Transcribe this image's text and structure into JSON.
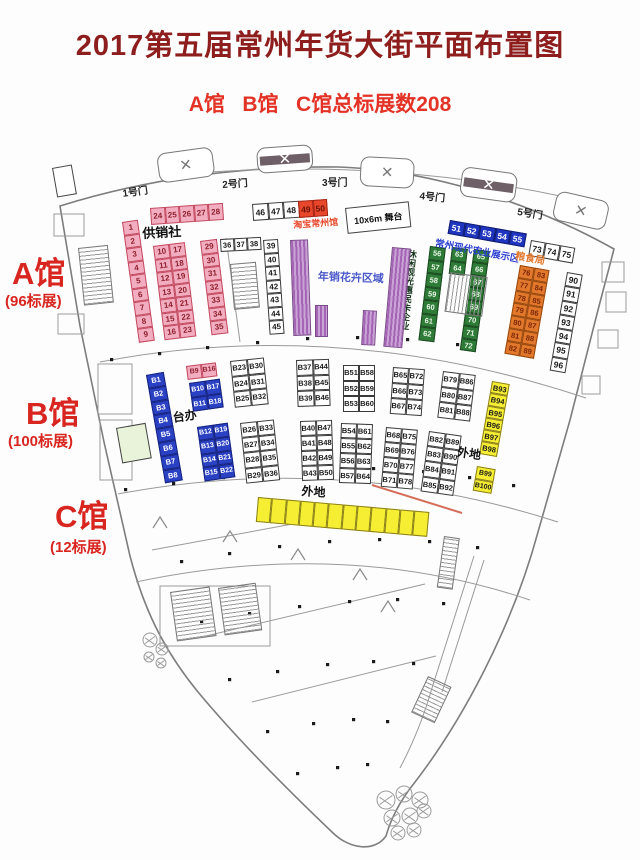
{
  "title": "2017第五届常州年货大街平面布置图",
  "subtitle": "A馆   B馆   C馆总标展数208",
  "colors": {
    "title": "#8e1d1d",
    "subtitle": "#e33226",
    "hall_label": "#d8251f",
    "purple_strip_dark": "#a565b5",
    "purple_strip_light": "#c9a2d6"
  },
  "plan": {
    "booth_styles": {
      "pink": {
        "bg": "#f2aec0",
        "border": "#c34a60",
        "text": "#8e1f2e"
      },
      "red": {
        "bg": "#e8472b",
        "border": "#a32413",
        "text": "#6d1208"
      },
      "white": {
        "bg": "#ffffff",
        "border": "#3a3a3a",
        "text": "#1a1a1a"
      },
      "blue": {
        "bg": "#2b41c4",
        "border": "#16247f",
        "text": "#ffffff"
      },
      "bluestrip": {
        "bg": "#1f35c0",
        "border": "#101d6e",
        "text": "#ffffff"
      },
      "green": {
        "bg": "#2f7c39",
        "border": "#1b4a20",
        "text": "#eaf6e6"
      },
      "orange": {
        "bg": "#e2782b",
        "border": "#96480e",
        "text": "#7a2606"
      },
      "yellow": {
        "bg": "#f6ee33",
        "border": "#8a7f1a",
        "text": "#1a1a1a"
      }
    },
    "groups": [
      {
        "name": "a-col-1-9",
        "x": 122,
        "y": 222,
        "rot": -8,
        "cols": 1,
        "cw": 16,
        "ch": 13.5,
        "fs": 8,
        "style": "pink",
        "values": [
          "1",
          "2",
          "3",
          "4",
          "5",
          "6",
          "7",
          "8",
          "9"
        ]
      },
      {
        "name": "a-row-24-28",
        "x": 150,
        "y": 208,
        "rot": -4,
        "cols": 5,
        "cw": 14.5,
        "ch": 17,
        "fs": 8,
        "style": "pink",
        "values": [
          "24",
          "25",
          "26",
          "27",
          "28"
        ]
      },
      {
        "name": "a-grid-10-23",
        "x": 153,
        "y": 246,
        "rot": -7,
        "cols": 2,
        "cw": 16,
        "ch": 13.5,
        "fs": 8,
        "style": "pink",
        "values": [
          "10",
          "17",
          "11",
          "18",
          "12",
          "19",
          "13",
          "20",
          "14",
          "21",
          "15",
          "22",
          "16",
          "23"
        ]
      },
      {
        "name": "a-col-29-35",
        "x": 200,
        "y": 241,
        "rot": -7,
        "cols": 1,
        "cw": 17,
        "ch": 13.5,
        "fs": 8,
        "style": "pink",
        "values": [
          "29",
          "30",
          "31",
          "32",
          "33",
          "34",
          "35"
        ]
      },
      {
        "name": "a-row-36-38",
        "x": 220,
        "y": 239,
        "rot": -3,
        "cols": 3,
        "cw": 13.5,
        "ch": 13,
        "fs": 7.5,
        "style": "white",
        "values": [
          "36",
          "37",
          "38"
        ]
      },
      {
        "name": "a-col-39-45",
        "x": 263,
        "y": 240,
        "rot": -4,
        "cols": 1,
        "cw": 15,
        "ch": 13.5,
        "fs": 8,
        "style": "white",
        "values": [
          "39",
          "40",
          "41",
          "42",
          "43",
          "44",
          "45"
        ]
      },
      {
        "name": "a-row-46-48",
        "x": 252,
        "y": 204,
        "rot": -4,
        "cols": 3,
        "cw": 15.5,
        "ch": 17,
        "fs": 8.5,
        "style": "white",
        "values": [
          "46",
          "47",
          "48"
        ]
      },
      {
        "name": "a-row-49-50",
        "x": 298,
        "y": 201,
        "rot": -4,
        "cols": 2,
        "cw": 14.5,
        "ch": 17,
        "fs": 8.5,
        "style": "red",
        "values": [
          "49",
          "50"
        ]
      },
      {
        "name": "a-strip-51-55",
        "x": 450,
        "y": 220,
        "rot": 10,
        "cols": 5,
        "cw": 15.5,
        "ch": 14,
        "fs": 8.5,
        "style": "bluestrip",
        "values": [
          "51",
          "52",
          "53",
          "54",
          "55"
        ]
      },
      {
        "name": "a-col-56-62",
        "x": 430,
        "y": 246,
        "rot": 7,
        "cols": 1,
        "cw": 16,
        "ch": 13.5,
        "fs": 7.5,
        "style": "green",
        "values": [
          "56",
          "57",
          "58",
          "59",
          "60",
          "61",
          "62"
        ]
      },
      {
        "name": "a-col-63-64",
        "x": 452,
        "y": 247,
        "rot": 7,
        "cols": 1,
        "cw": 16,
        "ch": 13.5,
        "fs": 7.5,
        "style": "green",
        "values": [
          "63",
          "64"
        ]
      },
      {
        "name": "a-col-65-72",
        "x": 474,
        "y": 249,
        "rot": 8,
        "cols": 1,
        "cw": 16,
        "ch": 12.8,
        "fs": 7.5,
        "style": "green",
        "values": [
          "65",
          "66",
          "67",
          "68",
          "69",
          "70",
          "71",
          "72"
        ]
      },
      {
        "name": "a-row-73-75",
        "x": 531,
        "y": 240,
        "rot": 10,
        "cols": 3,
        "cw": 15,
        "ch": 16,
        "fs": 8.5,
        "style": "white",
        "values": [
          "73",
          "74",
          "75"
        ]
      },
      {
        "name": "a-grid-76-89",
        "x": 520,
        "y": 265,
        "rot": 10,
        "cols": 2,
        "cw": 15,
        "ch": 12.8,
        "fs": 7.5,
        "style": "orange",
        "values": [
          "76",
          "83",
          "77",
          "84",
          "78",
          "85",
          "79",
          "86",
          "80",
          "87",
          "81",
          "88",
          "82",
          "89"
        ]
      },
      {
        "name": "a-col-90-96",
        "x": 567,
        "y": 272,
        "rot": 10,
        "cols": 1,
        "cw": 15.5,
        "ch": 14.3,
        "fs": 8.5,
        "style": "white",
        "values": [
          "90",
          "91",
          "92",
          "93",
          "94",
          "95",
          "96"
        ]
      },
      {
        "name": "b-col-b1-b8",
        "x": 146,
        "y": 375,
        "rot": -10,
        "cols": 1,
        "cw": 18,
        "ch": 13.8,
        "fs": 7.5,
        "style": "blue",
        "values": [
          "B1",
          "B2",
          "B3",
          "B4",
          "B5",
          "B6",
          "B7",
          "B8"
        ]
      },
      {
        "name": "b-row-b9-b16",
        "x": 186,
        "y": 366,
        "rot": -7,
        "cols": 2,
        "cw": 15,
        "ch": 13.5,
        "fs": 7,
        "style": "pink",
        "values": [
          "B9",
          "B16"
        ]
      },
      {
        "name": "b-grid-b10-b18",
        "x": 189,
        "y": 383,
        "rot": -8,
        "cols": 2,
        "cw": 15.5,
        "ch": 14.5,
        "fs": 7,
        "style": "blue",
        "values": [
          "B10",
          "B17",
          "B11",
          "B18"
        ]
      },
      {
        "name": "b-grid-b12-b22",
        "x": 197,
        "y": 427,
        "rot": -8,
        "cols": 2,
        "cw": 15.5,
        "ch": 13.8,
        "fs": 7,
        "style": "blue",
        "values": [
          "B12",
          "B19",
          "B13",
          "B20",
          "B14",
          "B21",
          "B15",
          "B22"
        ]
      },
      {
        "name": "b-grid-b23-b32",
        "x": 230,
        "y": 361,
        "rot": -6,
        "cols": 2,
        "cw": 17,
        "ch": 15.5,
        "fs": 7.5,
        "style": "white",
        "values": [
          "B23",
          "B30",
          "B24",
          "B31",
          "B25",
          "B32"
        ]
      },
      {
        "name": "b-grid-b26-b36",
        "x": 240,
        "y": 423,
        "rot": -6,
        "cols": 2,
        "cw": 17,
        "ch": 15.2,
        "fs": 7.5,
        "style": "white",
        "values": [
          "B26",
          "B33",
          "B27",
          "B34",
          "B28",
          "B35",
          "B29",
          "B36"
        ]
      },
      {
        "name": "b-grid-b37-b46",
        "x": 296,
        "y": 360,
        "rot": -2,
        "cols": 2,
        "cw": 16.5,
        "ch": 15.5,
        "fs": 7.5,
        "style": "white",
        "values": [
          "B37",
          "B44",
          "B38",
          "B45",
          "B39",
          "B46"
        ]
      },
      {
        "name": "b-grid-b40-b50",
        "x": 300,
        "y": 421,
        "rot": -2,
        "cols": 2,
        "cw": 16,
        "ch": 15,
        "fs": 7.5,
        "style": "white",
        "values": [
          "B40",
          "B47",
          "B41",
          "B48",
          "B42",
          "B49",
          "B43",
          "B50"
        ]
      },
      {
        "name": "b-grid-b51-b60",
        "x": 343,
        "y": 365,
        "rot": 0,
        "cols": 2,
        "cw": 16,
        "ch": 15.5,
        "fs": 7.5,
        "style": "white",
        "values": [
          "B51",
          "B58",
          "B52",
          "B59",
          "B53",
          "B60"
        ]
      },
      {
        "name": "b-grid-b54-b64",
        "x": 341,
        "y": 423,
        "rot": 2,
        "cols": 2,
        "cw": 16,
        "ch": 15,
        "fs": 7.5,
        "style": "white",
        "values": [
          "B54",
          "B61",
          "B55",
          "B62",
          "B56",
          "B63",
          "B57",
          "B64"
        ]
      },
      {
        "name": "b-grid-b65-b74",
        "x": 393,
        "y": 367,
        "rot": 4,
        "cols": 2,
        "cw": 16,
        "ch": 15.5,
        "fs": 7.5,
        "style": "white",
        "values": [
          "B65",
          "B72",
          "B66",
          "B73",
          "B67",
          "B74"
        ]
      },
      {
        "name": "b-grid-b68-b78",
        "x": 386,
        "y": 427,
        "rot": 5,
        "cols": 2,
        "cw": 16,
        "ch": 15,
        "fs": 7.5,
        "style": "white",
        "values": [
          "B68",
          "B75",
          "B69",
          "B76",
          "B70",
          "B77",
          "B71",
          "B78"
        ]
      },
      {
        "name": "b-grid-b79-b88",
        "x": 443,
        "y": 371,
        "rot": 7,
        "cols": 2,
        "cw": 16.5,
        "ch": 15.5,
        "fs": 7.5,
        "style": "white",
        "values": [
          "B79",
          "B86",
          "B80",
          "B87",
          "B81",
          "B88"
        ]
      },
      {
        "name": "b-grid-b82-b92",
        "x": 429,
        "y": 431,
        "rot": 8,
        "cols": 2,
        "cw": 16.5,
        "ch": 15.2,
        "fs": 7.5,
        "style": "white",
        "values": [
          "B82",
          "B89",
          "B83",
          "B90",
          "B84",
          "B91",
          "B85",
          "B92"
        ]
      },
      {
        "name": "b-col-b93-b98",
        "x": 492,
        "y": 381,
        "rot": 10,
        "cols": 1,
        "cw": 18,
        "ch": 12.3,
        "fs": 7.5,
        "style": "yellow",
        "values": [
          "B93",
          "B94",
          "B95",
          "B96",
          "B97",
          "B98"
        ]
      },
      {
        "name": "b-col-b99-b100",
        "x": 477,
        "y": 466,
        "rot": 10,
        "cols": 1,
        "cw": 19,
        "ch": 12.5,
        "fs": 7,
        "style": "yellow",
        "values": [
          "B99",
          "B100"
        ]
      },
      {
        "name": "c-strip",
        "x": 258,
        "y": 497,
        "rot": 5,
        "cols": 12,
        "cw": 14.3,
        "ch": 25,
        "fs": 8,
        "style": "yellow",
        "values": [
          "",
          "",
          "",
          "",
          "",
          "",
          "",
          "",
          "",
          "",
          "",
          ""
        ]
      }
    ],
    "labels": [
      {
        "name": "hall-a-label",
        "text": "A馆",
        "x": 12,
        "y": 258,
        "size": 31,
        "color": "#d8251f"
      },
      {
        "name": "hall-a-count",
        "text": "(96标展)",
        "x": 5,
        "y": 294,
        "size": 15,
        "color": "#d8251f"
      },
      {
        "name": "hall-b-label",
        "text": "B馆",
        "x": 26,
        "y": 398,
        "size": 31,
        "color": "#d8251f"
      },
      {
        "name": "hall-b-count",
        "text": "(100标展)",
        "x": 8,
        "y": 434,
        "size": 15,
        "color": "#d8251f"
      },
      {
        "name": "hall-c-label",
        "text": "C馆",
        "x": 55,
        "y": 501,
        "size": 31,
        "color": "#d8251f"
      },
      {
        "name": "hall-c-count",
        "text": "(12标展)",
        "x": 50,
        "y": 540,
        "size": 15,
        "color": "#d8251f"
      },
      {
        "name": "gate-1-label",
        "text": "1号门",
        "x": 122,
        "y": 190,
        "size": 10,
        "color": "#222",
        "rot": -8
      },
      {
        "name": "gate-2-label",
        "text": "2号门",
        "x": 222,
        "y": 181,
        "size": 10,
        "color": "#222",
        "rot": -4
      },
      {
        "name": "gate-3-label",
        "text": "3号门",
        "x": 322,
        "y": 179,
        "size": 10,
        "color": "#222",
        "rot": 0
      },
      {
        "name": "gate-4-label",
        "text": "4号门",
        "x": 420,
        "y": 192,
        "size": 10,
        "color": "#222",
        "rot": 6
      },
      {
        "name": "gate-5-label",
        "text": "5号门",
        "x": 518,
        "y": 208,
        "size": 10,
        "color": "#222",
        "rot": 9
      },
      {
        "name": "gongxiaoshe-label",
        "text": "供销社",
        "x": 142,
        "y": 227,
        "size": 13,
        "color": "#111",
        "rot": -3
      },
      {
        "name": "taobao-label",
        "text": "淘宝常州馆",
        "x": 293,
        "y": 221,
        "size": 9,
        "color": "#e8472b",
        "rot": -4
      },
      {
        "name": "flower-zone-label",
        "text": "年销花卉区域",
        "x": 318,
        "y": 272,
        "size": 11,
        "color": "#4958c8",
        "rot": 2
      },
      {
        "name": "agri-zone-label",
        "text": "常州现代农业展示区",
        "x": 436,
        "y": 239,
        "size": 9.5,
        "color": "#2b3fd0",
        "rot": 11
      },
      {
        "name": "leisure-label",
        "text": "休闲观光惠民卡企业",
        "x": 407,
        "y": 249,
        "size": 9,
        "color": "#14331a",
        "rot": 6,
        "vertical": true
      },
      {
        "name": "grain-label",
        "text": "粮食局",
        "x": 516,
        "y": 252,
        "size": 10,
        "color": "#e2782b",
        "rot": 10
      },
      {
        "name": "taiban-label",
        "text": "台办",
        "x": 172,
        "y": 412,
        "size": 12,
        "color": "#111",
        "rot": -8
      },
      {
        "name": "waidi-right-label",
        "text": "外地",
        "x": 458,
        "y": 446,
        "size": 12,
        "color": "#111",
        "rot": 8
      },
      {
        "name": "waidi-c-label",
        "text": "外地",
        "x": 302,
        "y": 485,
        "size": 12,
        "color": "#111",
        "rot": 4
      }
    ],
    "shapes": [
      {
        "name": "stage-box",
        "type": "box",
        "x": 345,
        "y": 208,
        "w": 64,
        "h": 26,
        "rot": -6,
        "text": "10x6m 舞台"
      },
      {
        "name": "kiosk-left",
        "type": "box",
        "x": 52,
        "y": 168,
        "w": 20,
        "h": 30,
        "rot": -10,
        "text": ""
      },
      {
        "name": "room-green",
        "type": "box",
        "x": 116,
        "y": 428,
        "w": 30,
        "h": 36,
        "rot": -10,
        "text": "",
        "fill": "#e8f3da"
      },
      {
        "name": "flower-strip-1",
        "type": "pstripe",
        "x": 290,
        "y": 240,
        "w": 18,
        "h": 96,
        "rot": -2
      },
      {
        "name": "flower-strip-2",
        "type": "pstripe",
        "x": 315,
        "y": 305,
        "w": 13,
        "h": 32,
        "rot": 0
      },
      {
        "name": "flower-strip-3",
        "type": "pstripe",
        "x": 363,
        "y": 310,
        "w": 14,
        "h": 35,
        "rot": 3
      },
      {
        "name": "flower-strip-4",
        "type": "pstripe",
        "x": 392,
        "y": 247,
        "w": 19,
        "h": 100,
        "rot": 5
      },
      {
        "name": "stair-1",
        "type": "hatch",
        "x": 78,
        "y": 248,
        "w": 30,
        "h": 58,
        "rot": -6
      },
      {
        "name": "stair-2",
        "type": "hatch",
        "x": 230,
        "y": 264,
        "w": 26,
        "h": 46,
        "rot": -5
      },
      {
        "name": "stair-3",
        "type": "hatch",
        "x": 450,
        "y": 272,
        "w": 38,
        "h": 40,
        "rot": 8,
        "horiz": true
      },
      {
        "name": "stair-4",
        "type": "hatch",
        "x": 170,
        "y": 592,
        "w": 40,
        "h": 50,
        "rot": -8
      },
      {
        "name": "stair-5",
        "type": "hatch",
        "x": 218,
        "y": 588,
        "w": 38,
        "h": 48,
        "rot": -8
      },
      {
        "name": "stair-6",
        "type": "hatch",
        "x": 428,
        "y": 676,
        "w": 26,
        "h": 40,
        "rot": 25
      },
      {
        "name": "stair-7",
        "type": "hatch",
        "x": 444,
        "y": 536,
        "w": 16,
        "h": 52,
        "rot": 8
      }
    ],
    "entrances": [
      {
        "name": "entrance-1",
        "x": 156,
        "y": 154,
        "w": 54,
        "h": 28,
        "rot": -8,
        "band": false
      },
      {
        "name": "entrance-2",
        "x": 256,
        "y": 148,
        "w": 54,
        "h": 24,
        "rot": -4,
        "band": true
      },
      {
        "name": "entrance-3",
        "x": 361,
        "y": 156,
        "w": 52,
        "h": 28,
        "rot": 3,
        "band": false
      },
      {
        "name": "entrance-4",
        "x": 463,
        "y": 166,
        "w": 54,
        "h": 28,
        "rot": 8,
        "band": true
      },
      {
        "name": "entrance-5",
        "x": 558,
        "y": 190,
        "w": 52,
        "h": 28,
        "rot": 13,
        "band": false
      }
    ]
  }
}
